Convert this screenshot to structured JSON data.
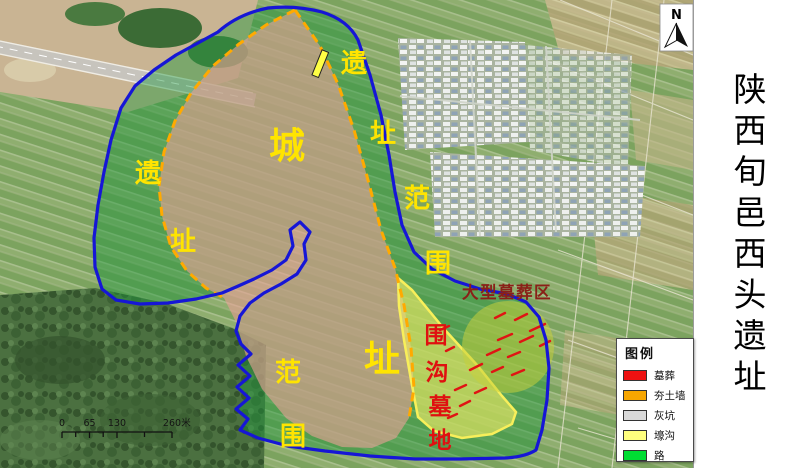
{
  "title_panel": {
    "title": "陕西旬邑西头遗址"
  },
  "map": {
    "colors": {
      "boundary": "#1616d6",
      "wall": "#ffaa00",
      "site_fill": "rgba(32,150,62,0.45)",
      "city_fill": "rgba(233,160,150,0.62)",
      "cemetery_fill": "rgba(240,236,100,0.62)",
      "cemetery_stroke": "#f8ef5a",
      "tomb_area_fill": "rgba(198,208,60,0.55)",
      "tomb_mark": "#e01414",
      "moat_fill": "#ffff44",
      "label_yellow": "#ffe400",
      "label_red": "#e01010",
      "tomb_area_text": "#8a2018"
    },
    "labels": {
      "city": [
        "城",
        "址"
      ],
      "west": [
        "遗",
        "址"
      ],
      "east": [
        "遗",
        "址",
        "范",
        "围"
      ],
      "south": [
        "范",
        "围"
      ],
      "cemetery": [
        "围",
        "沟",
        "墓",
        "地"
      ],
      "tomb_area": "大型墓葬区"
    },
    "north": {
      "label": "N"
    },
    "scale_bar": {
      "ticks": [
        "0",
        "65",
        "130",
        "260"
      ],
      "unit": "米"
    }
  },
  "legend": {
    "title": "图例",
    "items": [
      {
        "label": "墓葬",
        "color": "#ee1111"
      },
      {
        "label": "夯土墙",
        "color": "#f7a600"
      },
      {
        "label": "灰坑",
        "color": "#d9d9d9"
      },
      {
        "label": "壕沟",
        "color": "#ffff7e"
      },
      {
        "label": "路",
        "color": "#00dd33"
      }
    ]
  }
}
